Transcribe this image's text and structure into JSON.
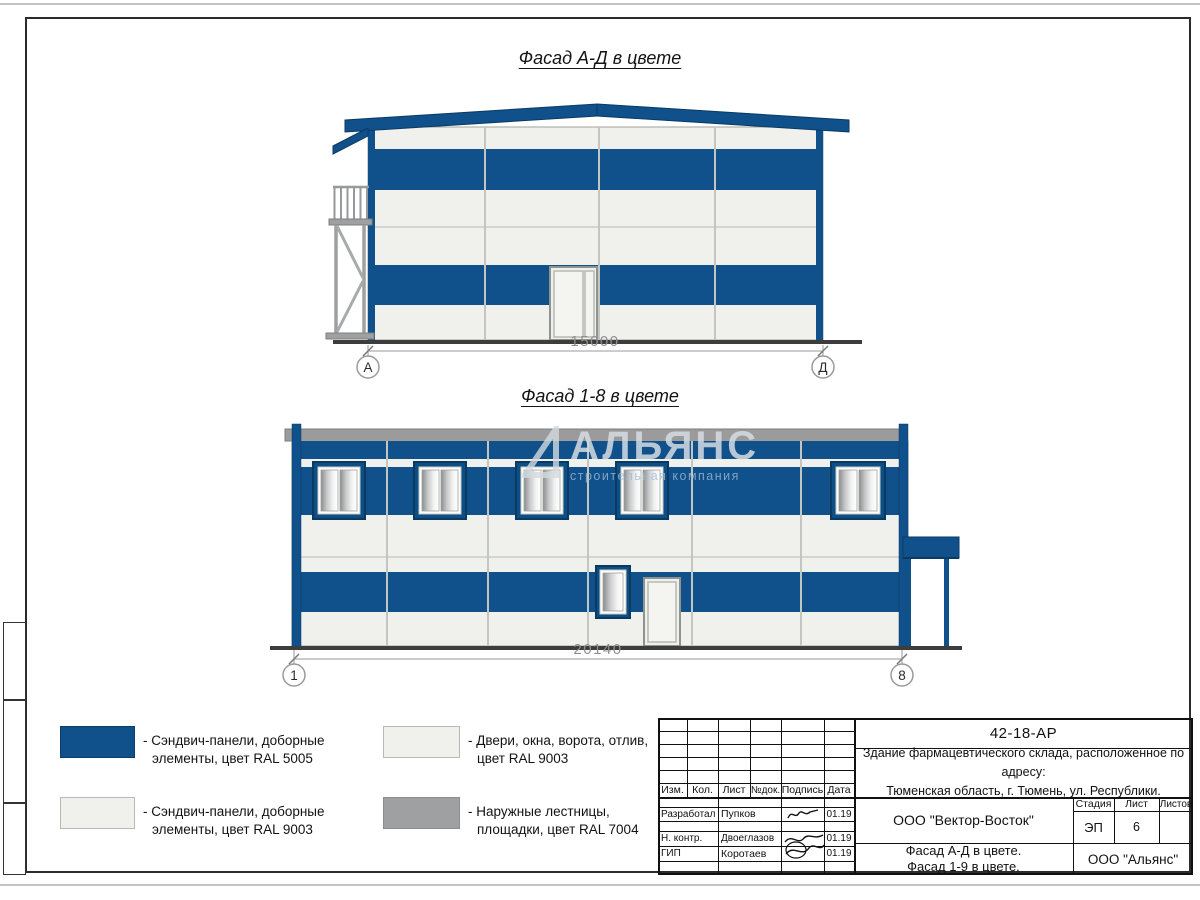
{
  "facade_ad": {
    "title": "Фасад А-Д в цвете",
    "dimension": "15000",
    "axis_left": "А",
    "axis_right": "Д"
  },
  "facade_18": {
    "title": "Фасад 1-8 в цвете",
    "dimension": "20140",
    "axis_left": "1",
    "axis_right": "8"
  },
  "watermark": {
    "brand": "АЛЬЯНС",
    "tagline": "строительная компания"
  },
  "legend": {
    "items": [
      {
        "label": "- Сэндвич-панели, доборные\nэлементы, цвет RAL 5005",
        "color": "#10518c"
      },
      {
        "label": "- Сэндвич-панели, доборные\nэлементы, цвет RAL 9003",
        "color": "#f0f1ec"
      },
      {
        "label": "- Двери, окна, ворота, отлив,\nцвет RAL 9003",
        "color": "#f0f1ec"
      },
      {
        "label": "- Наружные лестницы,\nплощадки, цвет RAL 7004",
        "color": "#9ea0a1"
      }
    ]
  },
  "titleblock": {
    "doc_number": "42-18-АР",
    "project_description": "Здание фармацевтического склада, расположенное по адресу:\nТюменская область, г. Тюмень, ул. Республики.",
    "header_cols": [
      "Изм.",
      "Кол.",
      "Лист",
      "№док.",
      "Подпись",
      "Дата"
    ],
    "signature_rows": [
      {
        "role": "Разработал",
        "name": "Пупков",
        "date": "01.19"
      },
      {
        "role": "Н. контр.",
        "name": "Двоеглазов",
        "date": "01.19"
      },
      {
        "role": "ГИП",
        "name": "Коротаев",
        "date": "01.19"
      }
    ],
    "contractor": "ООО \"Вектор-Восток\"",
    "sheet_title": "Фасад А-Д в цвете.\nФасад 1-9 в цвете.",
    "designer_org": "ООО \"Альянс\"",
    "stage_label": "Стадия",
    "sheet_label": "Лист",
    "sheets_label": "Листов",
    "stage_value": "ЭП",
    "sheet_value": "6",
    "sheets_value": ""
  },
  "colors": {
    "ral5005_blue": "#10518c",
    "ral9003_white": "#f0f1ec",
    "ral7004_gray": "#9ea0a1",
    "roof_gray": "#9b9b9b"
  }
}
